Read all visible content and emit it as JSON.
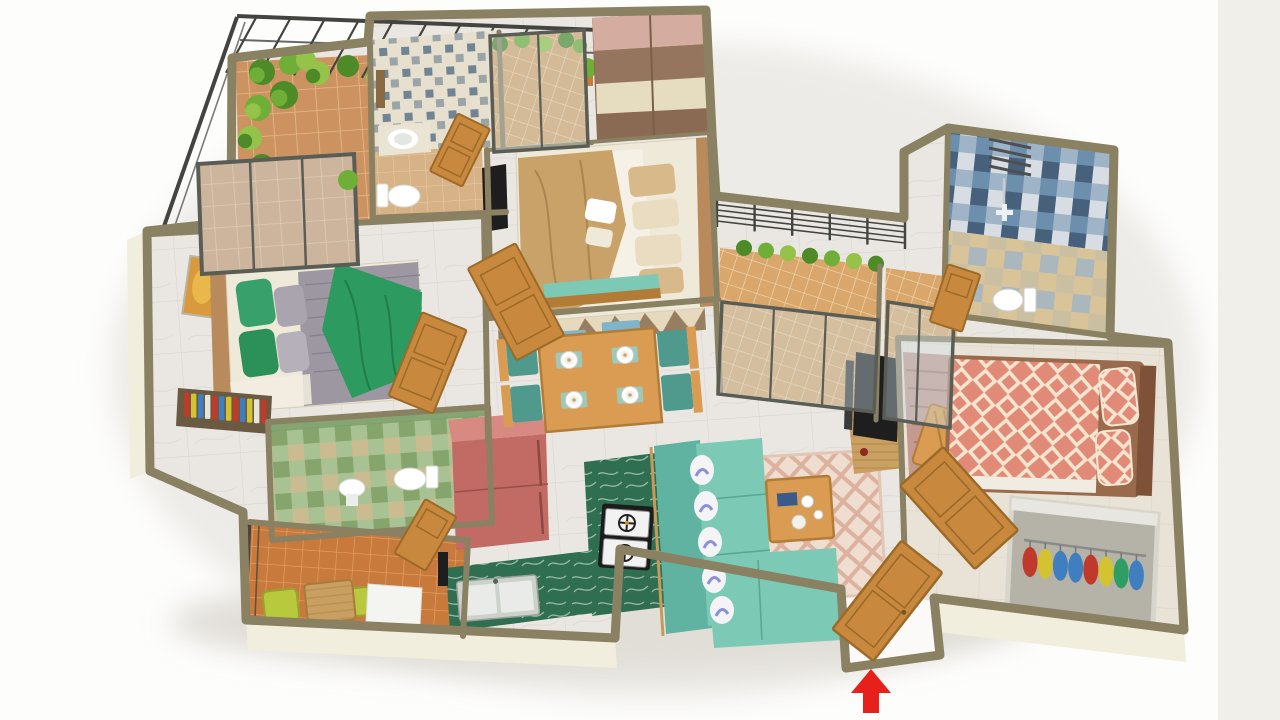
{
  "meta": {
    "title": "3 BHK Apartment – 3D Isometric Floor Plan Render",
    "description": "Bird's-eye 3D render of a furnished three-bedroom apartment on a white studio background",
    "view": "top-down isometric",
    "entrance_marker": "red upward arrow at main entrance door"
  },
  "rooms": [
    {
      "name": "terrace garden",
      "floor": "terracotta tiles",
      "features": [
        "pergola slats",
        "metal railing",
        "shrub border",
        "potted plant"
      ]
    },
    {
      "name": "common bathroom",
      "floor": "tan tiles",
      "features": [
        "patterned accent wall",
        "wash basin",
        "toilet",
        "mirror",
        "wooden door"
      ]
    },
    {
      "name": "master bedroom",
      "floor": "marble",
      "features": [
        "sliding wardrobe",
        "double bed with tan bedding",
        "wall tv",
        "teal bench",
        "triangle rug",
        "blue mats"
      ]
    },
    {
      "name": "master balcony",
      "floor": "terracotta plaid tiles",
      "features": [
        "glass sliding door",
        "planter"
      ]
    },
    {
      "name": "bedroom two",
      "floor": "beige tiles",
      "features": [
        "coral diamond bedding",
        "open wardrobe with clothes",
        "striped mauve rug",
        "wooden chair",
        "wooden door"
      ]
    },
    {
      "name": "bathroom two",
      "floor": "tan and blue checker",
      "features": [
        "blue tiled walls",
        "shower",
        "toilet",
        "vent grill",
        "wooden door"
      ]
    },
    {
      "name": "balcony one",
      "floor": "terracotta plaid tiles",
      "features": [
        "glass sliding doors",
        "bar railing",
        "planter shrubs"
      ]
    },
    {
      "name": "balcony two",
      "floor": "terracotta plaid tiles",
      "features": [
        "glass sliding doors"
      ]
    },
    {
      "name": "bedroom three",
      "floor": "marble",
      "features": [
        "grey quilt with green throw",
        "green pillows",
        "wooden headboard",
        "framed wall art",
        "bookshelf with colorful books",
        "terrace glass door"
      ]
    },
    {
      "name": "bathroom three",
      "floor": "green checker tiles",
      "features": [
        "wash basin",
        "toilet",
        "wooden door"
      ]
    },
    {
      "name": "utility balcony",
      "floor": "orange tiles",
      "features": [
        "two lime chairs",
        "wicker table",
        "washing machine",
        "dark railing"
      ]
    },
    {
      "name": "kitchen",
      "floor": "marble",
      "features": [
        "red refrigerator",
        "green marble counters",
        "two burner hob",
        "double steel sink"
      ]
    },
    {
      "name": "dining area",
      "floor": "marble",
      "features": [
        "wooden four seat table",
        "teal chairs",
        "plates and placemats"
      ]
    },
    {
      "name": "living room",
      "floor": "marble",
      "features": [
        "teal l-shaped sofa",
        "white and blue cushions",
        "pink lattice rug",
        "wooden coffee table",
        "tv console"
      ]
    },
    {
      "name": "entrance",
      "floor": "white threshold",
      "features": [
        "open wooden door",
        "red arrow marker"
      ]
    }
  ],
  "book_colors": [
    "#c0392b",
    "#d4c331",
    "#3f7fc0",
    "#e8e4d8",
    "#c0392b",
    "#3f7fc0",
    "#d4c331",
    "#c0392b",
    "#3f7fc0",
    "#d4c331",
    "#e8e4d8",
    "#c0392b"
  ],
  "clothes_colors": [
    "#c0392b",
    "#d4c331",
    "#3f7fc0",
    "#3f7fc0",
    "#c0392b",
    "#d4c331",
    "#2e9e62",
    "#3f7fc0"
  ],
  "palette": {
    "bg": "#fdfdfc",
    "bg_strip": "#f1efe9",
    "wall": "#8a8163",
    "wall_face": "#f2eedd",
    "marble": "#eae7e3",
    "marble_line": "#d9d5cf",
    "terracotta": "#cc9260",
    "terracotta_line": "#e5ba8c",
    "plaid": "#d9a76c",
    "plaid_line": "#f0d7ae",
    "orange_tile": "#c8793c",
    "orange_line": "#e5a268",
    "tan_floor": "#d7b286",
    "tan_line": "#e8cda6",
    "chain_wall_bg": "#e7e0ce",
    "chain_wall_fg": "#5d7489",
    "blue1": "#6c8fae",
    "blue2": "#9fb4c6",
    "blue3": "#47617d",
    "blue4": "#d7dde3",
    "tanblue_base": "#d9c49a",
    "green_t1": "#a9c293",
    "green_t2": "#85a56d",
    "green_t3": "#cbbb90",
    "glass": "#cfe0e8",
    "frame_gray": "#5a5d55",
    "railing": "#43443f",
    "plant1": "#4e8a28",
    "plant2": "#6fae37",
    "plant3": "#95c34a",
    "pot": "#c97b3a",
    "wood": "#d99c52",
    "wood_dark": "#b37c36",
    "door_wood": "#c8893f",
    "door_edge": "#9c6a28",
    "fridge_top": "#d88a82",
    "fridge_front": "#c26b64",
    "fridge_line": "#9a4f49",
    "counter_green": "#2f6e50",
    "counter_vein": "#dfe8e2",
    "steel": "#ccd1cc",
    "steel_dark": "#9aa09a",
    "stove": "#1c1c1c",
    "burner": "#f2f2f2",
    "white": "#ffffff",
    "off_white": "#f2ede1",
    "teal_sofa": "#7cc9b6",
    "teal_dark": "#5fb3a0",
    "teal_chair": "#4f9a8c",
    "pillow": "#f4f4f6",
    "pillow_blue": "#8a90d8",
    "rug_pink_base": "#efddd0",
    "rug_pink_line": "#dcb29e",
    "rug_tri_base": "#e6d9be",
    "rug_tri": "#8a6f50",
    "rug_maroon": "#c49a90",
    "rug_maroon_line": "#a87c72",
    "mat_blue": "#7fb4c9",
    "bed_tan": "#c8a268",
    "bed_tan_dark": "#ab8550",
    "sheet": "#efe9da",
    "pillow_tan": "#d8b98a",
    "pillow_cream": "#e9dcc0",
    "gray_blanket": "#9d97a2",
    "gray_blanket_line": "#86808c",
    "green_throw": "#2d9a60",
    "green_throw_dark": "#1f7d4a",
    "green_pillow": "#38a06a",
    "gray_pillow": "#aaa4ae",
    "headboard": "#b98a5c",
    "coral": "#e28a78",
    "coral_cream": "#f4e6cf",
    "coral_frame": "#9a6a4c",
    "mattress_white": "#f1ece1",
    "wardrobe_pink": "#d4aca0",
    "wardrobe_brown": "#96755e",
    "wardrobe_cream": "#e6dcc0",
    "wardrobe_brown2": "#8a6a52",
    "tv": "#1e1e1e",
    "art1": "#d89a3c",
    "art2": "#e8b84a",
    "lime_chair": "#b8c93e",
    "lime_dark": "#96a52e",
    "washer": "#f4f4f1",
    "washer_door": "#c6ccce",
    "arrow": "#e6201a",
    "shelf_wood": "#6b5a42",
    "rail_gray": "#8a8a8a",
    "wr2_frame": "#d8d5cc",
    "wr2_inner": "#b5b2a8",
    "bed2_floor": "#e9e3d7",
    "wicker": "#c9a061"
  }
}
